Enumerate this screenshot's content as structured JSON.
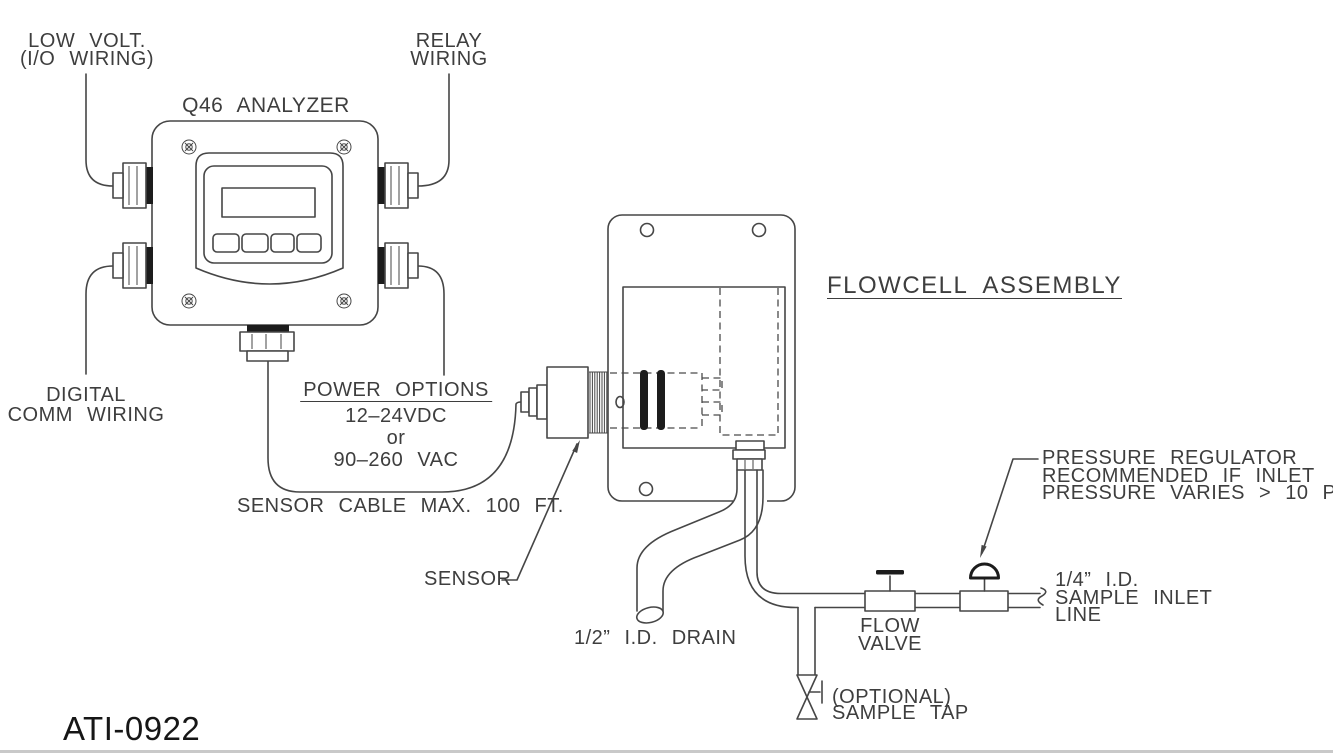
{
  "drawing": {
    "doc_number": "ATI-0922",
    "colors": {
      "line": "#464646",
      "text": "#3e3e3e",
      "dark_fill": "#1c1c1c",
      "page_rule": "#c9c9c9",
      "background": "#ffffff"
    },
    "labels": {
      "low_volt": [
        "LOW VOLT.",
        "(I/O WIRING)"
      ],
      "relay": [
        "RELAY",
        "WIRING"
      ],
      "analyzer_title": "Q46 ANALYZER",
      "digital_comm": [
        "DIGITAL",
        "COMM WIRING"
      ],
      "power_title": "POWER OPTIONS",
      "power_lines": [
        "12–24VDC",
        "or",
        "90–260 VAC"
      ],
      "sensor_cable": "SENSOR CABLE MAX. 100 FT.",
      "flowcell_title": "FLOWCELL ASSEMBLY",
      "sensor": "SENSOR",
      "drain": "1/2” I.D. DRAIN",
      "flow_valve": [
        "FLOW",
        "VALVE"
      ],
      "pressure_note": [
        "PRESSURE REGULATOR",
        "RECOMMENDED IF INLET",
        "PRESSURE VARIES > 10 PSI"
      ],
      "inlet": [
        "1/4” I.D.",
        "SAMPLE INLET",
        "LINE"
      ],
      "sample_tap": [
        "(OPTIONAL)",
        "SAMPLE TAP"
      ]
    }
  }
}
